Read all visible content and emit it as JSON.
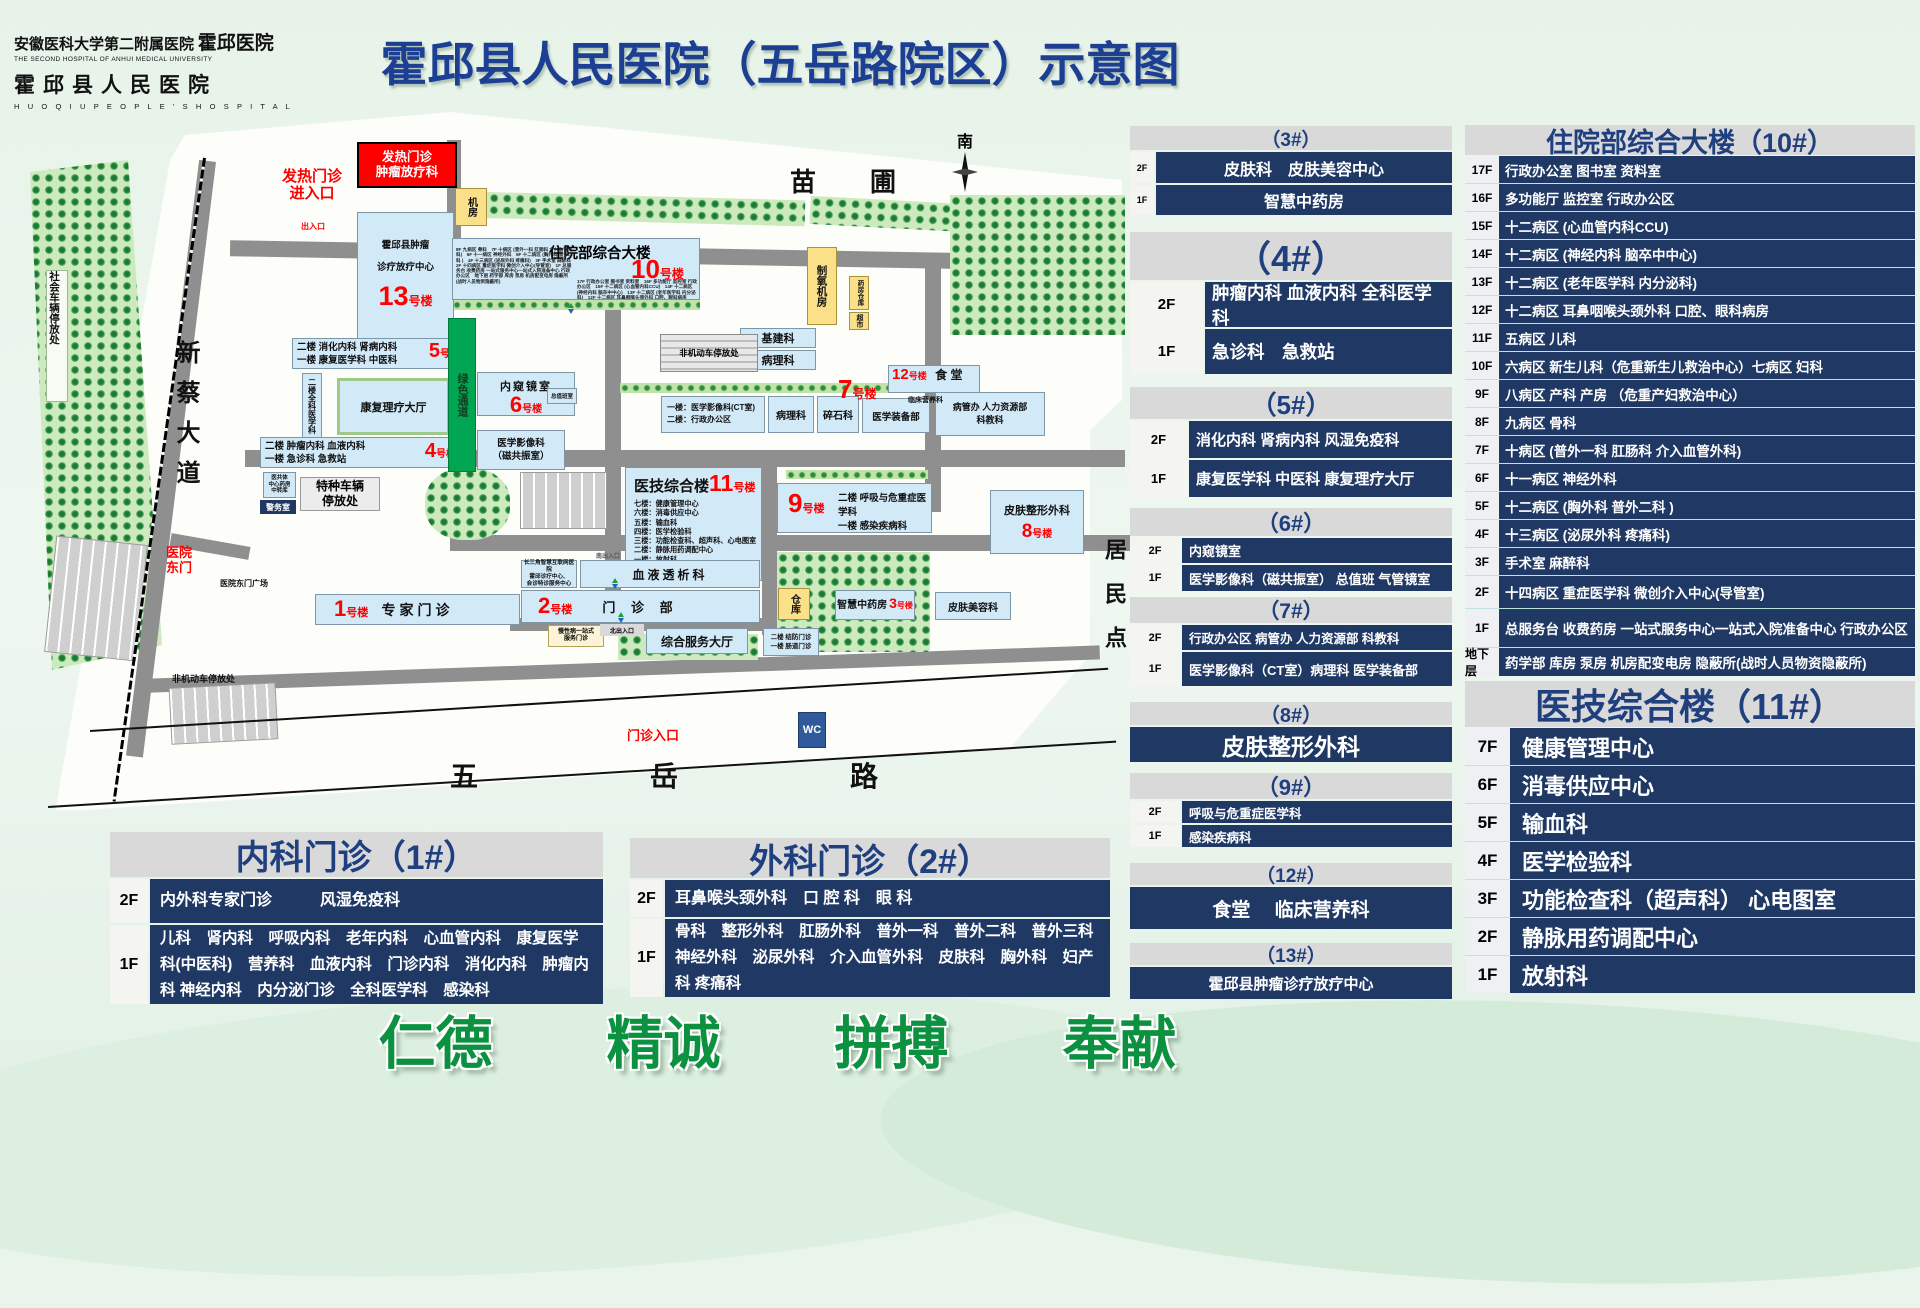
{
  "logo": {
    "cn1": "安徽医科大学第二附属医院",
    "cn1b": "霍邱医院",
    "en1": "THE SECOND HOSPITAL OF ANHUI MEDICAL UNIVERSITY",
    "cn2": "霍邱县人民医院",
    "en2": "H U O Q I U   P E O P L E ' S   H O S P I T A L"
  },
  "title": "霍邱县人民医院（五岳路院区）示意图",
  "slogan": "仁德　　精诚　　拼搏　　奉献",
  "map": {
    "suffix": "号楼",
    "fever_box_l1": "发热门诊",
    "fever_box_l2": "肿瘤放疗科",
    "fever_entry_l1": "发热门诊",
    "fever_entry_l2": "进入口",
    "exit_small": "出入口",
    "jifang": "机房",
    "oxygen": "制氧机房",
    "pharmacy_store": "药房仓库",
    "supermarket": "超市",
    "jijian": "基建科",
    "bingli_top": "病理科",
    "nonmotor_center": "非机动车停放处",
    "nursery": "苗　圃",
    "south": "南",
    "residents": "居民点",
    "xincai": "新蔡大道",
    "social_parking": "社会车辆停放处",
    "east_gate_l1": "医院",
    "east_gate_l2": "东门",
    "east_gate_square": "医院东门广场",
    "nonmotor_left": "非机动车停放处",
    "outpatient_entry": "门诊入口",
    "wuyue": "五　岳　路",
    "wc": "WC",
    "b13": {
      "l1": "霍邱县肿瘤",
      "l2": "诊疗放疗中心",
      "num": "13"
    },
    "b10": {
      "title": "住院部综合大楼",
      "num": "10"
    },
    "b12": {
      "num": "12",
      "name": "食 堂",
      "sub": "临床营养科"
    },
    "b5": {
      "l1": "二楼 消化内科 肾病内科",
      "l2": "一楼 康复医学科 中医科",
      "num": "5"
    },
    "quanke": "二楼全科医学科",
    "kangfu_hall": "康复理疗大厅",
    "b4": {
      "l1": "二楼 肿瘤内科 血液内科",
      "l2": "一楼 急诊科 急救站",
      "num": "4"
    },
    "green_channel": "绿色通道",
    "b6": {
      "name": "内窥镜室",
      "num": "6",
      "duty": "总值班室",
      "mri1": "医学影像科",
      "mri2": "（磁共振室）"
    },
    "ygt_l1": "医共体",
    "ygt_l2": "中心药房",
    "ygt_l3": "中转库",
    "police": "警务室",
    "special_parking_l1": "特种车辆",
    "special_parking_l2": "停放处",
    "b7": {
      "num": "7",
      "box1l1": "一楼：医学影像科(CT室)",
      "box1l2": "二楼：行政办公区",
      "bingli": "病理科",
      "suishi": "碎石科",
      "zhuangbei": "医学装备部",
      "bgb1": "病管办 人力资源部",
      "bgb2": "科教科"
    },
    "b11": {
      "title": "医技综合楼",
      "num": "11",
      "f7": "七楼：健康管理中心",
      "f6": "六楼：消毒供应中心",
      "f5": "五楼：输血科",
      "f4": "四楼：医学检验科",
      "f3": "三楼：功能检查科、超声科、心电图室",
      "f2": "二楼：静脉用药调配中心",
      "f1": "一楼：放射科"
    },
    "b9": {
      "num": "9",
      "l1": "二楼 呼吸与危重症医学科",
      "l2": "一楼 感染疾病科"
    },
    "b8": {
      "name": "皮肤整形外科",
      "num": "8"
    },
    "dialysis": "血液透析科",
    "csj_l1": "长三角智慧互联网医院",
    "csj_l2": "霍邱诊疗中心、",
    "csj_l3": "会诊特诊服务中心",
    "b2": {
      "num": "2",
      "name": "门  诊  部"
    },
    "south_exit": "南出入口",
    "north_exit": "北出入口",
    "chronic_l1": "慢性病一站式",
    "chronic_l2": "服务门诊",
    "service_hall": "综合服务大厅",
    "jiefang_l1": "二楼 结防门诊",
    "jiefang_l2": "一楼 肠道门诊",
    "warehouse": "仓库",
    "b3": {
      "name": "智慧中药房",
      "num": "3"
    },
    "skin_beauty": "皮肤美容科",
    "b1": {
      "num": "1",
      "name": "专家门诊"
    }
  },
  "panels": {
    "p3": {
      "id": "（3#）",
      "rows": [
        {
          "f": "2F",
          "t": "皮肤科　皮肤美容中心"
        },
        {
          "f": "1F",
          "t": "智慧中药房"
        }
      ]
    },
    "p4": {
      "id": "（4#）",
      "rows": [
        {
          "f": "2F",
          "t": "肿瘤内科 血液内科 全科医学科"
        },
        {
          "f": "1F",
          "t": "急诊科　急救站"
        }
      ]
    },
    "p5": {
      "id": "（5#）",
      "rows": [
        {
          "f": "2F",
          "t": "消化内科 肾病内科 风湿免疫科"
        },
        {
          "f": "1F",
          "t": "康复医学科 中医科 康复理疗大厅"
        }
      ]
    },
    "p6": {
      "id": "（6#）",
      "rows": [
        {
          "f": "2F",
          "t": "内窥镜室"
        },
        {
          "f": "1F",
          "t": "医学影像科（磁共振室） 总值班 气管镜室"
        }
      ]
    },
    "p7": {
      "id": "（7#）",
      "rows": [
        {
          "f": "2F",
          "t": "行政办公区 病管办 人力资源部 科教科"
        },
        {
          "f": "1F",
          "t": "医学影像科（CT室）病理科 医学装备部"
        }
      ]
    },
    "p8": {
      "id": "（8#）",
      "full": "皮肤整形外科"
    },
    "p9": {
      "id": "（9#）",
      "rows": [
        {
          "f": "2F",
          "t": "呼吸与危重症医学科"
        },
        {
          "f": "1F",
          "t": "感染疾病科"
        }
      ]
    },
    "p12": {
      "id": "（12#）",
      "full": "食堂　 临床营养科"
    },
    "p13": {
      "id": "（13#）",
      "full": "霍邱县肿瘤诊疗放疗中心"
    }
  },
  "building10": {
    "title": "住院部综合大楼（10#）",
    "rows": [
      {
        "f": "17F",
        "t": "行政办公室 图书室 资料室"
      },
      {
        "f": "16F",
        "t": "多功能厅 监控室 行政办公区"
      },
      {
        "f": "15F",
        "t": "十二病区 (心血管内科CCU)"
      },
      {
        "f": "14F",
        "t": "十二病区 (神经内科 脑卒中中心)"
      },
      {
        "f": "13F",
        "t": "十二病区 (老年医学科 内分泌科)"
      },
      {
        "f": "12F",
        "t": "十二病区 耳鼻咽喉头颈外科 口腔、眼科病房"
      },
      {
        "f": "11F",
        "t": "五病区 儿科"
      },
      {
        "f": "10F",
        "t": "六病区 新生儿科（危重新生儿救治中心）七病区 妇科"
      },
      {
        "f": "9F",
        "t": "八病区 产科 产房 （危重产妇救治中心）"
      },
      {
        "f": "8F",
        "t": "九病区 骨科"
      },
      {
        "f": "7F",
        "t": "十病区 (普外一科 肛肠科 介入血管外科)"
      },
      {
        "f": "6F",
        "t": "十一病区 神经外科"
      },
      {
        "f": "5F",
        "t": "十二病区 (胸外科 普外二科 )"
      },
      {
        "f": "4F",
        "t": "十三病区 (泌尿外科 疼痛科)"
      },
      {
        "f": "3F",
        "t": "手术室 麻醉科"
      },
      {
        "f": "2F",
        "t": "十四病区 重症医学科 微创介入中心(导管室)"
      },
      {
        "f": "1F",
        "t": "总服务台 收费药房 一站式服务中心一站式入院准备中心 行政办公区"
      },
      {
        "f": "地下层",
        "t": "药学部 库房 泵房 机房配变电房 隐蔽所(战时人员物资隐蔽所)"
      }
    ]
  },
  "building11": {
    "title": "医技综合楼（11#）",
    "rows": [
      {
        "f": "7F",
        "t": "健康管理中心"
      },
      {
        "f": "6F",
        "t": "消毒供应中心"
      },
      {
        "f": "5F",
        "t": "输血科"
      },
      {
        "f": "4F",
        "t": "医学检验科"
      },
      {
        "f": "3F",
        "t": "功能检查科（超声科）  心电图室"
      },
      {
        "f": "2F",
        "t": "静脉用药调配中心"
      },
      {
        "f": "1F",
        "t": "放射科"
      }
    ]
  },
  "clinic1": {
    "title": "内科门诊（1#）",
    "f2": "2F",
    "t2": "内外科专家门诊　　　风湿免疫科",
    "f1": "1F",
    "t1": "儿科　肾内科　呼吸内科　老年内科　心血管内科　康复医学科(中医科)　营养科　血液内科　门诊内科　消化内科　肿瘤内科 神经内科　内分泌门诊　全科医学科　感染科"
  },
  "clinic2": {
    "title": "外科门诊（2#）",
    "f2": "2F",
    "t2": "耳鼻喉头颈外科　口 腔 科　眼 科",
    "f1": "1F",
    "t1": "骨科　整形外科　肛肠外科　普外一科　普外二科　普外三科 神经外科　泌尿外科　介入血管外科　皮肤科　胸外科　妇产科 疼痛科"
  }
}
